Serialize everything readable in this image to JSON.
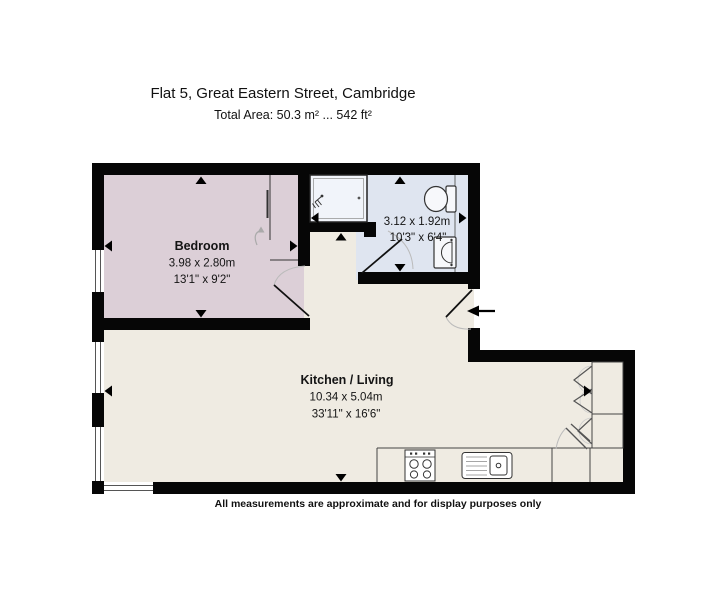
{
  "header": {
    "title": "Flat 5, Great Eastern Street, Cambridge",
    "total_area": "Total Area: 50.3 m² ... 542 ft²"
  },
  "rooms": {
    "bedroom": {
      "name": "Bedroom",
      "size_metric": "3.98 x 2.80m",
      "size_imperial": "13'1\" x 9'2\""
    },
    "bathroom": {
      "size_metric": "3.12 x 1.92m",
      "size_imperial": "10'3\" x 6'4\""
    },
    "kitchen_living": {
      "name": "Kitchen / Living",
      "size_metric": "10.34 x 5.04m",
      "size_imperial": "33'11\" x 16'6\""
    }
  },
  "footer": {
    "disclaimer": "All measurements are approximate and for display purposes only"
  },
  "colors": {
    "wall": "#060606",
    "bedroom_fill": "#dccfd7",
    "bathroom_fill": "#dfe5f0",
    "living_fill": "#efebe2",
    "shower_fill": "#f1f4fa",
    "fixture_fill": "#f7f8fb"
  },
  "icons": {
    "entry_arrow": "left-arrow",
    "dimension_marker": "small-triangle",
    "door": "quarter-circle-swing",
    "window": "double-line-in-wall",
    "shower": "shower-head-spray",
    "toilet": "cistern-and-bowl",
    "basin": "half-round-basin",
    "hob": "four-burner-rings",
    "kitchen_sink": "sink-with-drainer",
    "wardrobe_slide": "curved-gray-arrow",
    "bifold_door": "zigzag-v"
  }
}
